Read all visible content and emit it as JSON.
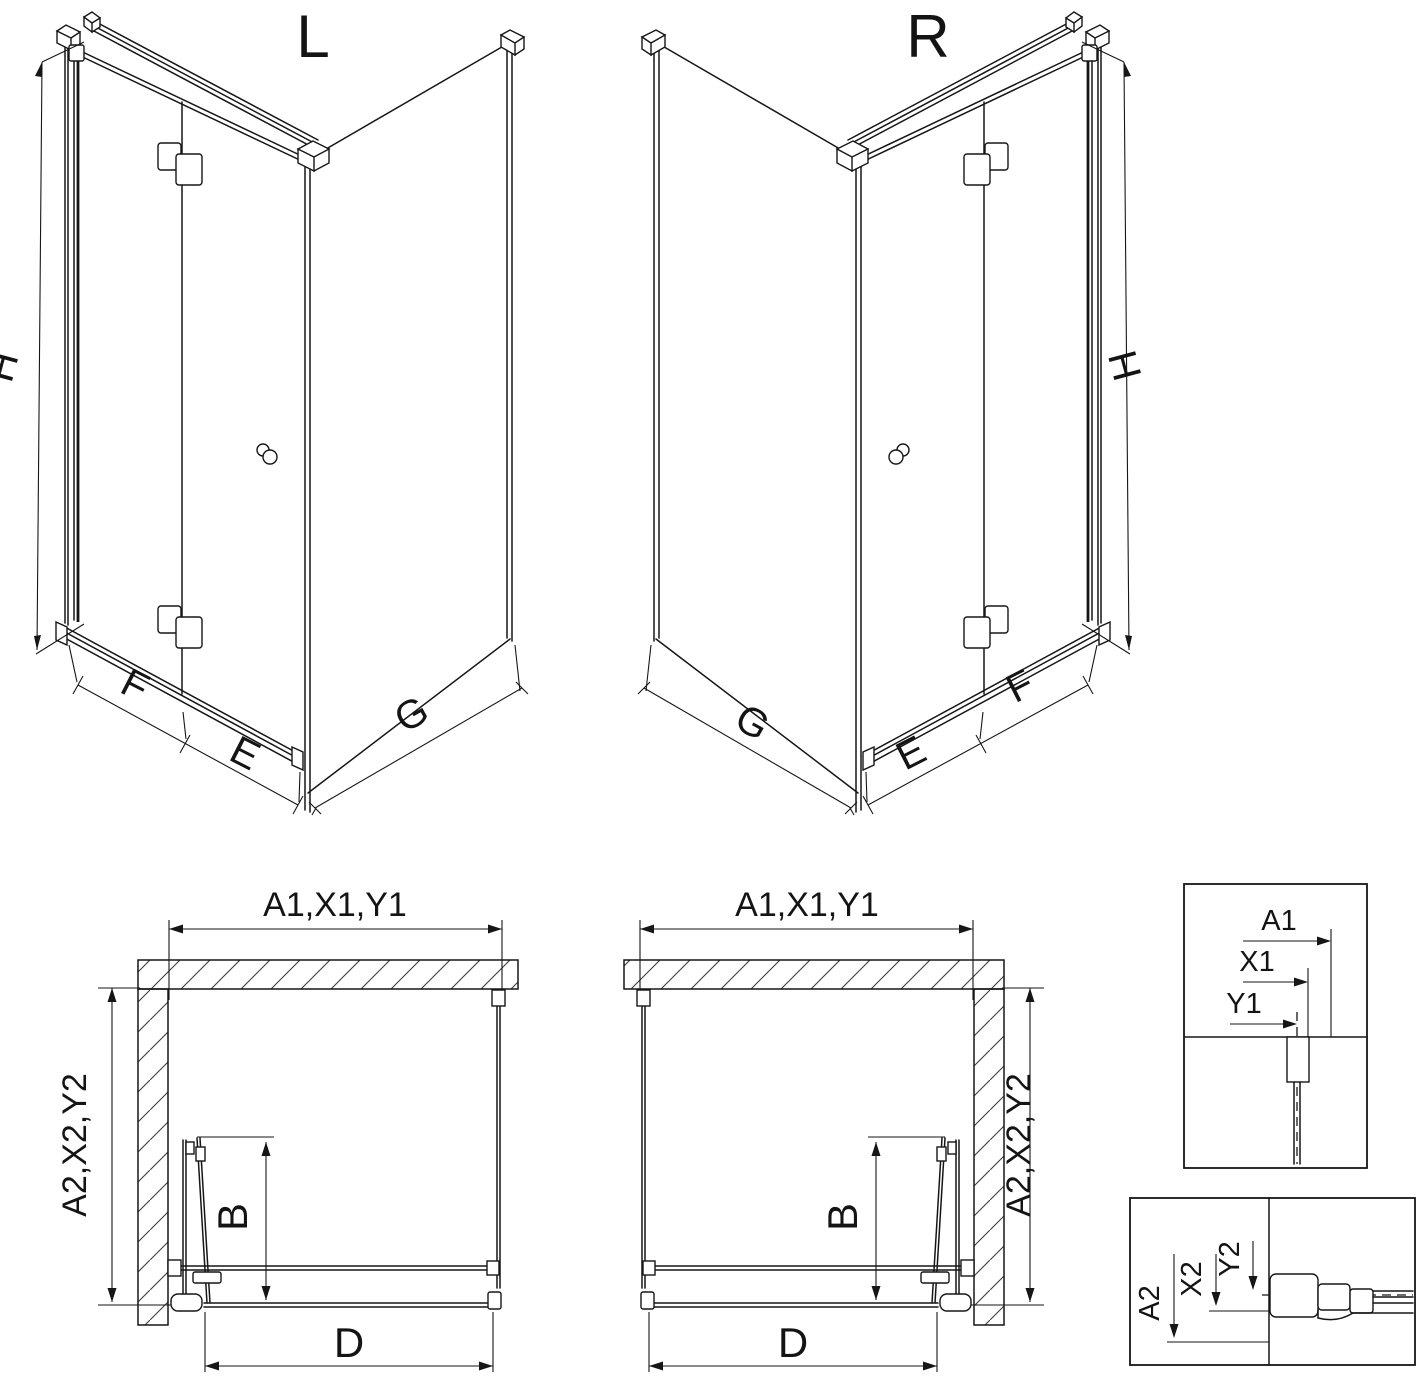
{
  "colors": {
    "background": "#ffffff",
    "line": "#161616"
  },
  "iso_left": {
    "label": "L",
    "dim_height": "H",
    "dim_front_fixed": "F",
    "dim_front_door": "E",
    "dim_side": "G"
  },
  "iso_right": {
    "label": "R",
    "dim_height": "H",
    "dim_front_fixed": "F",
    "dim_front_door": "E",
    "dim_side": "G"
  },
  "plan_left": {
    "dim_top": "A1,X1,Y1",
    "dim_side": "A2,X2,Y2",
    "dim_door": "B",
    "dim_width": "D"
  },
  "plan_right": {
    "dim_top": "A1,X1,Y1",
    "dim_side": "A2,X2,Y2",
    "dim_door": "B",
    "dim_width": "D"
  },
  "detail_top_right": {
    "dims": [
      "A1",
      "X1",
      "Y1"
    ]
  },
  "detail_bottom_right": {
    "dims": [
      "A2",
      "X2",
      "Y2"
    ]
  }
}
